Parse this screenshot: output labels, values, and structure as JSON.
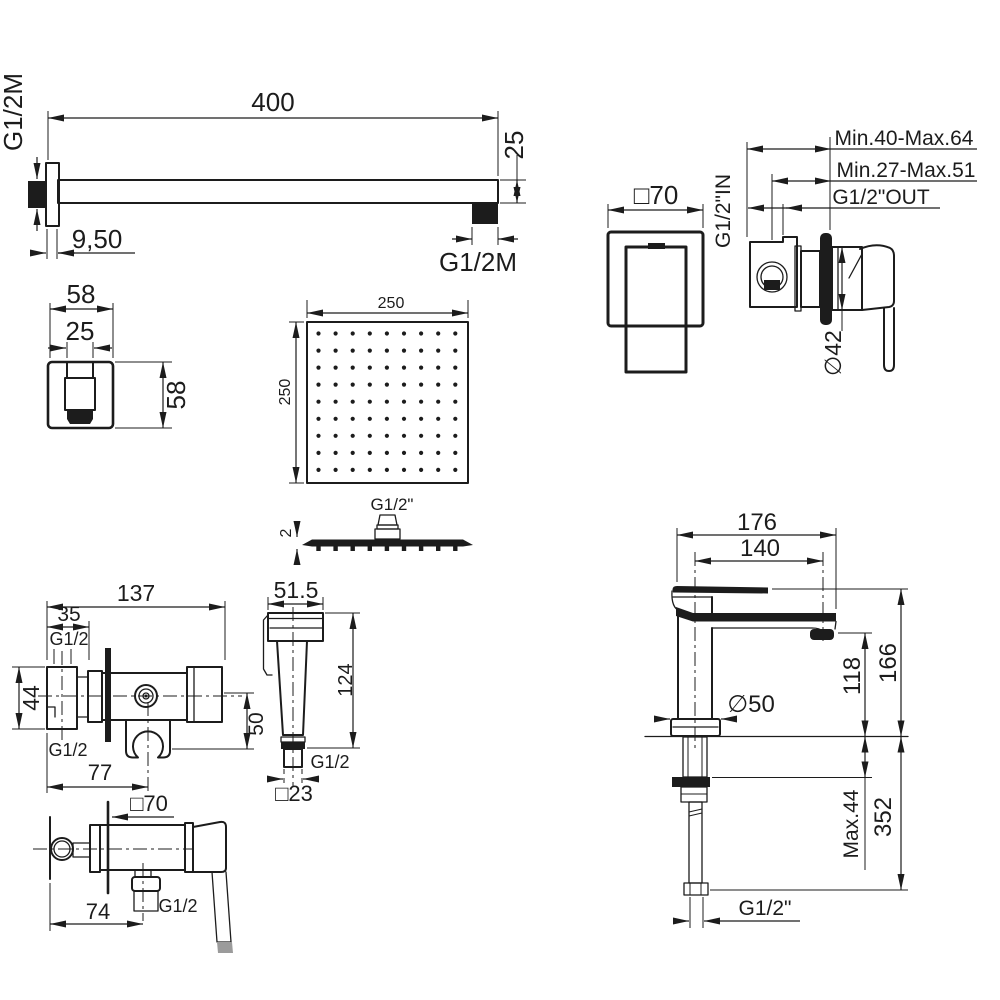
{
  "background": "#ffffff",
  "line_color": "#1c1c1c",
  "parts": {
    "shower_arm": {
      "length": "400",
      "height": "25",
      "flange_offset": "9,50",
      "wall_thread": "G1/2M",
      "outlet_thread": "G1/2M"
    },
    "wall_escutcheon": {
      "width": "58",
      "inner_width": "25",
      "height": "58"
    },
    "shower_head": {
      "width": "250",
      "depth": "250",
      "thread": "G1/2\"",
      "plate_thickness": "2",
      "nozzle_grid": {
        "rows": 9,
        "cols": 9
      }
    },
    "concealed_mixer": {
      "plate": "□70",
      "inlet_thread": "G1/2\"IN",
      "depth_range_outer": "Min.40-Max.64",
      "depth_range_inner": "Min.27-Max.51",
      "outlet_thread": "G1/2\"OUT",
      "trim_diameter": "∅42"
    },
    "angle_valve": {
      "total_length": "137",
      "inlet_length": "35",
      "top_thread": "G1/2",
      "body_height": "44",
      "bottom_thread": "G1/2",
      "base_length": "77",
      "holder_drop": "50"
    },
    "hand_sprayer": {
      "head_width": "51.5",
      "body_length": "124",
      "thread": "G1/2",
      "square": "□23"
    },
    "exposed_mixer": {
      "plate": "□70",
      "spacing": "74",
      "outlet_thread": "G1/2"
    },
    "basin_mixer": {
      "total_width": "176",
      "spout_reach": "140",
      "total_height": "166",
      "spout_height": "118",
      "base_diameter": "∅50",
      "deck_max": "Max.44",
      "under_height": "352",
      "thread": "G1/2\""
    }
  }
}
